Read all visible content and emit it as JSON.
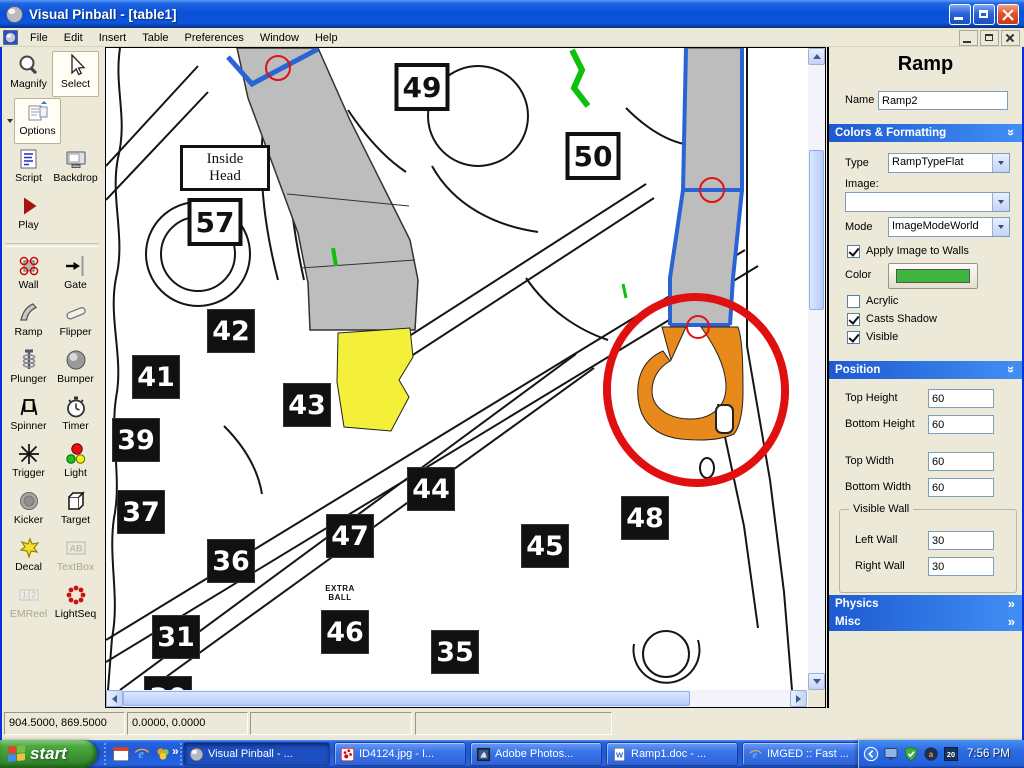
{
  "chrome": {
    "chevron": "»"
  },
  "window": {
    "title": "Visual Pinball - [table1]"
  },
  "menu": {
    "items": [
      "File",
      "Edit",
      "Insert",
      "Table",
      "Preferences",
      "Window",
      "Help"
    ]
  },
  "toolbox": {
    "buttons": [
      {
        "label": "Magnify",
        "icon": "magnify-icon",
        "state": "normal"
      },
      {
        "label": "Select",
        "icon": "select-icon",
        "state": "active",
        "has_dropdown": true
      },
      {
        "label": "Options",
        "icon": "options-icon",
        "state": "active"
      },
      {
        "label": "Script",
        "icon": "script-icon",
        "state": "normal"
      },
      {
        "label": "Backdrop",
        "icon": "backdrop-icon",
        "state": "normal"
      },
      {
        "label": "Play",
        "icon": "play-icon",
        "state": "normal"
      },
      {
        "label": "Wall",
        "icon": "wall-icon",
        "state": "normal"
      },
      {
        "label": "Gate",
        "icon": "gate-icon",
        "state": "normal"
      },
      {
        "label": "Ramp",
        "icon": "ramp-icon",
        "state": "normal"
      },
      {
        "label": "Flipper",
        "icon": "flipper-icon",
        "state": "normal"
      },
      {
        "label": "Plunger",
        "icon": "plunger-icon",
        "state": "normal"
      },
      {
        "label": "Bumper",
        "icon": "bumper-icon",
        "state": "normal"
      },
      {
        "label": "Spinner",
        "icon": "spinner-icon",
        "state": "normal"
      },
      {
        "label": "Timer",
        "icon": "timer-icon",
        "state": "normal"
      },
      {
        "label": "Trigger",
        "icon": "trigger-icon",
        "state": "normal"
      },
      {
        "label": "Light",
        "icon": "light-icon",
        "state": "normal"
      },
      {
        "label": "Kicker",
        "icon": "kicker-icon",
        "state": "normal"
      },
      {
        "label": "Target",
        "icon": "target-icon",
        "state": "normal"
      },
      {
        "label": "Decal",
        "icon": "decal-icon",
        "state": "normal"
      },
      {
        "label": "TextBox",
        "icon": "textbox-icon",
        "state": "disabled"
      },
      {
        "label": "EMReel",
        "icon": "emreel-icon",
        "state": "disabled"
      },
      {
        "label": "LightSeq",
        "icon": "lightseq-icon",
        "state": "normal"
      }
    ]
  },
  "canvas": {
    "boxed_plates": [
      {
        "label": "49",
        "x": 316,
        "y": 39
      },
      {
        "label": "50",
        "x": 487,
        "y": 108
      },
      {
        "label": "57",
        "x": 109,
        "y": 174
      }
    ],
    "black_plates": [
      {
        "label": "42",
        "x": 125,
        "y": 283
      },
      {
        "label": "41",
        "x": 50,
        "y": 329
      },
      {
        "label": "43",
        "x": 201,
        "y": 357
      },
      {
        "label": "39",
        "x": 30,
        "y": 392
      },
      {
        "label": "44",
        "x": 325,
        "y": 441
      },
      {
        "label": "37",
        "x": 35,
        "y": 464
      },
      {
        "label": "47",
        "x": 244,
        "y": 488
      },
      {
        "label": "36",
        "x": 125,
        "y": 513
      },
      {
        "label": "45",
        "x": 439,
        "y": 498
      },
      {
        "label": "48",
        "x": 539,
        "y": 470
      },
      {
        "label": "31",
        "x": 70,
        "y": 589
      },
      {
        "label": "46",
        "x": 239,
        "y": 584
      },
      {
        "label": "35",
        "x": 349,
        "y": 604
      },
      {
        "label": "30",
        "x": 62,
        "y": 650
      }
    ],
    "inside_head_line1": "Inside",
    "inside_head_line2": "Head",
    "extra_ball_line1": "EXTRA",
    "extra_ball_line2": "BALL"
  },
  "properties_panel": {
    "title": "Ramp",
    "name": {
      "label": "Name",
      "value": "Ramp2"
    },
    "sections": {
      "colors_formatting": {
        "title": "Colors & Formatting",
        "expanded": true
      },
      "position": {
        "title": "Position",
        "expanded": true
      },
      "physics": {
        "title": "Physics",
        "expanded": false
      },
      "misc": {
        "title": "Misc",
        "expanded": false
      }
    },
    "type": {
      "label": "Type",
      "value": "RampTypeFlat"
    },
    "image": {
      "label": "Image:",
      "value": ""
    },
    "mode": {
      "label": "Mode",
      "value": "ImageModeWorld"
    },
    "apply_image_to_walls": {
      "label": "Apply Image to Walls",
      "checked": true
    },
    "color": {
      "label": "Color",
      "swatch": "#3fb43f"
    },
    "acrylic": {
      "label": "Acrylic",
      "checked": false
    },
    "casts_shadow": {
      "label": "Casts Shadow",
      "checked": true
    },
    "visible": {
      "label": "Visible",
      "checked": true
    },
    "top_height": {
      "label": "Top Height",
      "value": "60"
    },
    "bottom_height": {
      "label": "Bottom Height",
      "value": "60"
    },
    "top_width": {
      "label": "Top Width",
      "value": "60"
    },
    "bottom_width": {
      "label": "Bottom Width",
      "value": "60"
    },
    "visible_wall": {
      "title": "Visible Wall",
      "left_wall": {
        "label": "Left Wall",
        "value": "30"
      },
      "right_wall": {
        "label": "Right Wall",
        "value": "30"
      }
    }
  },
  "statusbar": {
    "panel1": "904.5000, 869.5000",
    "panel2": "0.0000, 0.0000",
    "panel3": "",
    "panel4": ""
  },
  "taskbar": {
    "start_label": "start",
    "quick_launch_icons": [
      "app-window-icon",
      "ie-icon",
      "messenger-icon"
    ],
    "tasks": [
      {
        "label": "Visual Pinball - ...",
        "icon": "pinball-ball-icon",
        "active": true
      },
      {
        "label": "ID4124.jpg - I...",
        "icon": "irfanview-icon",
        "active": false
      },
      {
        "label": "Adobe Photos...",
        "icon": "photoshop-icon",
        "active": false
      },
      {
        "label": "Ramp1.doc - ...",
        "icon": "word-icon",
        "active": false
      },
      {
        "label": "IMGED :: Fast ...",
        "icon": "ie-icon",
        "active": false
      }
    ],
    "tray_icons": [
      "hide-icons-chevron-icon",
      "display-icon",
      "shield-icon",
      "a-icon",
      "calendar-20-icon"
    ],
    "clock": "7:56 PM"
  },
  "icon_glyphs": {
    "textbox": "AB",
    "emreel_1": "1",
    "emreel_2": "2",
    "word": "W",
    "ie": "e",
    "a": "a",
    "calendar": "20"
  },
  "colors": {
    "ramp_fill_gray": "#bdbdbd",
    "selection_blue": "#2a63d6",
    "control_point_red": "#e21212",
    "marker_red": "#e01010",
    "highlight_orange": "#e8891c",
    "highlight_yellow": "#f4ef39",
    "swatch_green": "#3fb43f"
  }
}
